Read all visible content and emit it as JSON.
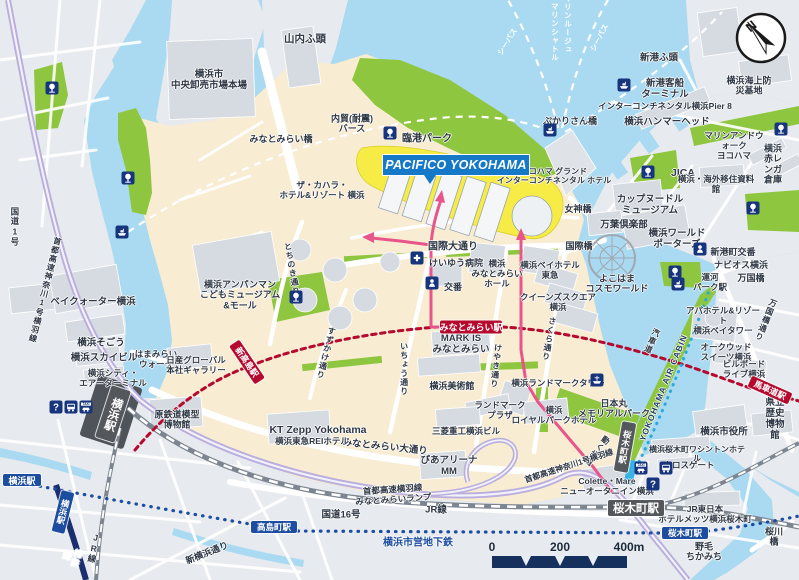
{
  "map": {
    "banner": {
      "text": "PACIFICO YOKOHAMA"
    },
    "compass": {
      "label": "N"
    },
    "scale_bar": {
      "start": "0",
      "mid": "200",
      "end": "400m"
    },
    "colors": {
      "water": "#a9daf1",
      "land_cream": "#f8ecd2",
      "land_gray": "#e7eaee",
      "park_green": "#8ec63f",
      "minatomirai_line_red": "#b5092e",
      "subway_blue": "#1d4da0",
      "jr_badge_gray": "#54585d",
      "walk_route_pink": "#e8558b",
      "highway_lavender": "#b9aedd",
      "air_cabin_blue": "#2ba8de",
      "banner_blue": "#1579c8",
      "scale_navy": "#16305e"
    },
    "labels": [
      {
        "t": "横浜市\n中央卸売市場本場",
        "x": 209,
        "y": 81,
        "fs": 9.5
      },
      {
        "t": "山内ふ頭",
        "x": 305,
        "y": 39,
        "fs": 10.5
      },
      {
        "t": "内貿(耐震)\nバース",
        "x": 352,
        "y": 124,
        "fs": 9
      },
      {
        "t": "臨港パーク",
        "x": 427,
        "y": 139,
        "fs": 10,
        "w": 1
      },
      {
        "t": "みなとみらい橋",
        "x": 281,
        "y": 139,
        "fs": 9
      },
      {
        "t": "ザ・カハラ・\nホテル&リゾート 横浜",
        "x": 322,
        "y": 191,
        "fs": 8.5
      },
      {
        "t": "ベイクォーター横浜",
        "x": 93,
        "y": 303,
        "fs": 9.5
      },
      {
        "t": "横浜アンパンマン\nこどもミュージアム\n&モール",
        "x": 240,
        "y": 295,
        "fs": 9
      },
      {
        "t": "横浜そごう",
        "x": 101,
        "y": 344,
        "fs": 9.5
      },
      {
        "t": "横浜スカイビル",
        "x": 104,
        "y": 359,
        "fs": 9.5
      },
      {
        "t": "横浜シティ・\nエアーターミナル",
        "x": 113,
        "y": 379,
        "fs": 8.5
      },
      {
        "t": "はまみらい\nウォーク",
        "x": 156,
        "y": 360,
        "fs": 8.5
      },
      {
        "t": "日産グローバル\n本社ギャラリー",
        "x": 196,
        "y": 366,
        "fs": 8.5
      },
      {
        "t": "原鉄道模型\n博物館",
        "x": 177,
        "y": 420,
        "fs": 9
      },
      {
        "t": "国道1号",
        "x": 14,
        "y": 227,
        "fs": 8.5,
        "v": 1
      },
      {
        "t": "首都高速神奈川1号横羽線",
        "x": 45,
        "y": 290,
        "fs": 8,
        "v": 1,
        "rot": 14
      },
      {
        "t": "新横浜通り",
        "x": 207,
        "y": 553,
        "fs": 9,
        "rot": -22
      },
      {
        "t": "相鉄線",
        "x": 71,
        "y": 557,
        "fs": 8.5,
        "v": 1,
        "rot": 16,
        "c": "#ffffff"
      },
      {
        "t": "JR線",
        "x": 93,
        "y": 548,
        "fs": 8.5,
        "v": 1,
        "rot": 10
      },
      {
        "t": "国道16号",
        "x": 341,
        "y": 516,
        "fs": 9.5
      },
      {
        "t": "JR線",
        "x": 436,
        "y": 511,
        "fs": 9.5
      },
      {
        "t": "横浜市営地下鉄",
        "x": 418,
        "y": 543,
        "fs": 10,
        "c": "#1d4da0",
        "w": 1
      },
      {
        "t": "首都高速横羽線\nみなとみらいランプ",
        "x": 393,
        "y": 495,
        "fs": 8.5,
        "rot": -4
      },
      {
        "t": "みなとみらい大通り",
        "x": 385,
        "y": 448,
        "fs": 9.5,
        "rot": 6
      },
      {
        "t": "KT Zepp Yokohama",
        "x": 318,
        "y": 430,
        "fs": 10.5,
        "w": 1
      },
      {
        "t": "横浜東急REIホテル",
        "x": 312,
        "y": 442,
        "fs": 8.5
      },
      {
        "t": "三菱重工横浜ビル",
        "x": 466,
        "y": 432,
        "fs": 8.5
      },
      {
        "t": "ぴあアリーナ\nMM",
        "x": 449,
        "y": 467,
        "fs": 9.5
      },
      {
        "t": "横浜美術館",
        "x": 452,
        "y": 386,
        "fs": 9
      },
      {
        "t": "MARK IS\nみなとみらい",
        "x": 461,
        "y": 345,
        "fs": 9.5,
        "w": 1
      },
      {
        "t": "いちょう通り",
        "x": 404,
        "y": 369,
        "fs": 8,
        "v": 1
      },
      {
        "t": "けやき通り",
        "x": 496,
        "y": 366,
        "fs": 8,
        "v": 1,
        "rot": 6
      },
      {
        "t": "さくら通り",
        "x": 549,
        "y": 339,
        "fs": 8,
        "v": 1,
        "rot": 10
      },
      {
        "t": "すずかけ通り",
        "x": 326,
        "y": 353,
        "fs": 8,
        "v": 1,
        "rot": 14
      },
      {
        "t": "とちのき通り",
        "x": 292,
        "y": 269,
        "fs": 8,
        "v": 1,
        "rot": -10
      },
      {
        "t": "国際大通り",
        "x": 453,
        "y": 247,
        "fs": 10
      },
      {
        "t": "けいゆう病院",
        "x": 456,
        "y": 263,
        "fs": 9
      },
      {
        "t": "交番",
        "x": 453,
        "y": 287,
        "fs": 9
      },
      {
        "t": "横浜\nみなとみらい\nホール",
        "x": 497,
        "y": 274,
        "fs": 8.5
      },
      {
        "t": "横浜ベイホテル\n東急",
        "x": 550,
        "y": 271,
        "fs": 8.5
      },
      {
        "t": "クイーンズスクエア\n横浜",
        "x": 558,
        "y": 303,
        "fs": 8.5
      },
      {
        "t": "横浜ランドマークタワー",
        "x": 558,
        "y": 384,
        "fs": 8.5
      },
      {
        "t": "ランドマーク\nプラザ",
        "x": 500,
        "y": 411,
        "fs": 8.5
      },
      {
        "t": "横浜\nロイヤルパークホテル",
        "x": 554,
        "y": 416,
        "fs": 8.5
      },
      {
        "t": "日本丸\nメモリアルパーク",
        "x": 614,
        "y": 409,
        "fs": 9
      },
      {
        "t": "動く歩道",
        "x": 597,
        "y": 451,
        "fs": 8,
        "v": 1,
        "rot": 38
      },
      {
        "t": "首都高速神奈川1号横羽線",
        "x": 569,
        "y": 466,
        "fs": 8,
        "rot": -18
      },
      {
        "t": "Colette・Mare\nニューオータニイン横浜",
        "x": 607,
        "y": 487,
        "fs": 8.5
      },
      {
        "t": "横浜桜木町ワシントンホテル",
        "x": 697,
        "y": 454,
        "fs": 8
      },
      {
        "t": "クロスゲート",
        "x": 689,
        "y": 466,
        "fs": 8.5
      },
      {
        "t": "JR東日本\nホテルメッツ横浜桜木町",
        "x": 705,
        "y": 515,
        "fs": 8.5
      },
      {
        "t": "桜川橋",
        "x": 774,
        "y": 537,
        "fs": 9
      },
      {
        "t": "野毛\nちかみち",
        "x": 704,
        "y": 552,
        "fs": 9
      },
      {
        "t": "横浜市役所",
        "x": 724,
        "y": 433,
        "fs": 9.5
      },
      {
        "t": "県立歴史\n博物館",
        "x": 775,
        "y": 420,
        "fs": 9.5
      },
      {
        "t": "アパホテル&リゾート\n横浜ベイタワー",
        "x": 723,
        "y": 321,
        "fs": 8.5
      },
      {
        "t": "オークウッド\nスイーツ横浜",
        "x": 726,
        "y": 353,
        "fs": 8.5
      },
      {
        "t": "ビルボード\nライブ横浜",
        "x": 744,
        "y": 370,
        "fs": 8.5
      },
      {
        "t": "万国橋通り",
        "x": 766,
        "y": 320,
        "fs": 8,
        "v": 1,
        "rot": 22
      },
      {
        "t": "万国橋",
        "x": 751,
        "y": 278,
        "fs": 9
      },
      {
        "t": "ナビオス横浜",
        "x": 741,
        "y": 265,
        "fs": 9
      },
      {
        "t": "新港町交番",
        "x": 733,
        "y": 252,
        "fs": 9
      },
      {
        "t": "運河\nパーク駅",
        "x": 710,
        "y": 283,
        "fs": 8.5
      },
      {
        "t": "よこはま\nコスモワールド",
        "x": 617,
        "y": 284,
        "fs": 9
      },
      {
        "t": "横浜ワールド\nポーターズ",
        "x": 677,
        "y": 240,
        "fs": 9.5
      },
      {
        "t": "カップヌードル\nミュージアム",
        "x": 650,
        "y": 206,
        "fs": 9.5
      },
      {
        "t": "万葉倶楽部",
        "x": 624,
        "y": 226,
        "fs": 9.5
      },
      {
        "t": "国際橋",
        "x": 579,
        "y": 246,
        "fs": 9
      },
      {
        "t": "女神橋",
        "x": 578,
        "y": 209,
        "fs": 9
      },
      {
        "t": "ヨコハマ グランド\nインターコンチネンタル ホテル",
        "x": 554,
        "y": 176,
        "fs": 8
      },
      {
        "t": "ぷかりさん橋",
        "x": 570,
        "y": 121,
        "fs": 9
      },
      {
        "t": "新港ふ頭",
        "x": 659,
        "y": 59,
        "fs": 9.5
      },
      {
        "t": "新港客船\nターミナル",
        "x": 665,
        "y": 90,
        "fs": 9.5
      },
      {
        "t": "横浜海上防災基地",
        "x": 749,
        "y": 86,
        "fs": 9
      },
      {
        "t": "インターコンチネンタル横浜Pier 8",
        "x": 665,
        "y": 107,
        "fs": 8.5
      },
      {
        "t": "横浜ハンマーヘッド",
        "x": 667,
        "y": 123,
        "fs": 9.5
      },
      {
        "t": "マリンアンドウォーク\nヨコハマ",
        "x": 734,
        "y": 146,
        "fs": 8.5
      },
      {
        "t": "横浜\n赤レンガ倉庫",
        "x": 773,
        "y": 164,
        "fs": 9
      },
      {
        "t": "JICA",
        "x": 683,
        "y": 173,
        "fs": 10.5,
        "w": 1
      },
      {
        "t": "横浜・海外移住資料館",
        "x": 716,
        "y": 185,
        "fs": 8.5
      },
      {
        "t": "マリンルージュ",
        "x": 567,
        "y": 24,
        "fs": 7.5,
        "v": 1,
        "c": "#ffffff",
        "cl": "w"
      },
      {
        "t": "マリンシャトル",
        "x": 554,
        "y": 32,
        "fs": 7.5,
        "v": 1,
        "c": "#ffffff",
        "cl": "w"
      },
      {
        "t": "シーバス",
        "x": 508,
        "y": 42,
        "fs": 7.5,
        "rot": -58,
        "c": "#ffffff",
        "cl": "w"
      },
      {
        "t": "シーバス",
        "x": 600,
        "y": 38,
        "fs": 7.5,
        "rot": -62,
        "c": "#ffffff",
        "cl": "w"
      },
      {
        "t": "汽車道",
        "x": 652,
        "y": 341,
        "fs": 8,
        "v": 1,
        "rot": 24
      },
      {
        "t": "YOKOHAMA AIR CABIN",
        "x": 664,
        "y": 388,
        "fs": 8.5,
        "rot": -68,
        "c": "#203a66",
        "ls": 1
      }
    ],
    "badges": [
      {
        "t": "みなとみらい駅",
        "type": "mm",
        "x": 471,
        "y": 327,
        "w": 62,
        "h": 13,
        "fs": 9
      },
      {
        "t": "新高島駅",
        "type": "mm",
        "x": 247,
        "y": 362,
        "w": 46,
        "h": 12,
        "fs": 8.5,
        "rot": 56
      },
      {
        "t": "馬車道駅",
        "type": "mm",
        "x": 770,
        "y": 390,
        "w": 44,
        "h": 12,
        "fs": 8.5,
        "rot": 24
      },
      {
        "t": "横浜駅",
        "type": "jr",
        "x": 113,
        "y": 414,
        "w": 20,
        "h": 54,
        "fs": 11.5,
        "rot": 18,
        "v": 1
      },
      {
        "t": "桜木町駅",
        "type": "jr",
        "x": 636,
        "y": 508,
        "w": 56,
        "h": 16,
        "fs": 11.5
      },
      {
        "t": "桜木町駅",
        "type": "jr",
        "x": 625,
        "y": 447,
        "w": 14,
        "h": 50,
        "fs": 8.5,
        "rot": 10,
        "v": 1
      },
      {
        "t": "横浜駅",
        "type": "sub",
        "x": 22,
        "y": 480,
        "w": 38,
        "h": 12,
        "fs": 9
      },
      {
        "t": "横浜駅",
        "type": "sub",
        "x": 63,
        "y": 512,
        "w": 13,
        "h": 42,
        "fs": 8.5,
        "rot": 14,
        "v": 1
      },
      {
        "t": "高島町駅",
        "type": "sub",
        "x": 274,
        "y": 527,
        "w": 46,
        "h": 12,
        "fs": 8.5
      },
      {
        "t": "桜木町駅",
        "type": "sub",
        "x": 685,
        "y": 533,
        "w": 46,
        "h": 12,
        "fs": 8.5
      }
    ],
    "icons": [
      {
        "n": "park-tree-icon",
        "x": 52,
        "y": 88
      },
      {
        "n": "park-tree-icon",
        "x": 128,
        "y": 178
      },
      {
        "n": "park-tree-icon",
        "x": 390,
        "y": 133
      },
      {
        "n": "park-tree-icon",
        "x": 296,
        "y": 297
      },
      {
        "n": "park-tree-icon",
        "x": 675,
        "y": 272
      },
      {
        "n": "park-tree-icon",
        "x": 648,
        "y": 172
      },
      {
        "n": "park-tree-icon",
        "x": 781,
        "y": 129
      },
      {
        "n": "park-tree-icon",
        "x": 753,
        "y": 208
      },
      {
        "n": "ferry-pier-icon",
        "x": 122,
        "y": 232
      },
      {
        "n": "ferry-pier-icon",
        "x": 550,
        "y": 130
      },
      {
        "n": "ferry-pier-icon",
        "x": 624,
        "y": 85
      },
      {
        "n": "ferry-pier-icon",
        "x": 678,
        "y": 284
      },
      {
        "n": "ship-nipponmaru-icon",
        "x": 597,
        "y": 380
      },
      {
        "n": "info-icon",
        "x": 56,
        "y": 407
      },
      {
        "n": "bus-icon",
        "x": 71,
        "y": 407
      },
      {
        "n": "taxi-icon",
        "x": 86,
        "y": 407
      },
      {
        "n": "taxi-icon",
        "x": 641,
        "y": 468
      },
      {
        "n": "bus-icon",
        "x": 666,
        "y": 468
      },
      {
        "n": "info-icon",
        "x": 653,
        "y": 484
      },
      {
        "n": "hospital-icon",
        "x": 417,
        "y": 258
      },
      {
        "n": "police-icon",
        "x": 432,
        "y": 283
      },
      {
        "n": "police-icon",
        "x": 700,
        "y": 249
      }
    ]
  }
}
